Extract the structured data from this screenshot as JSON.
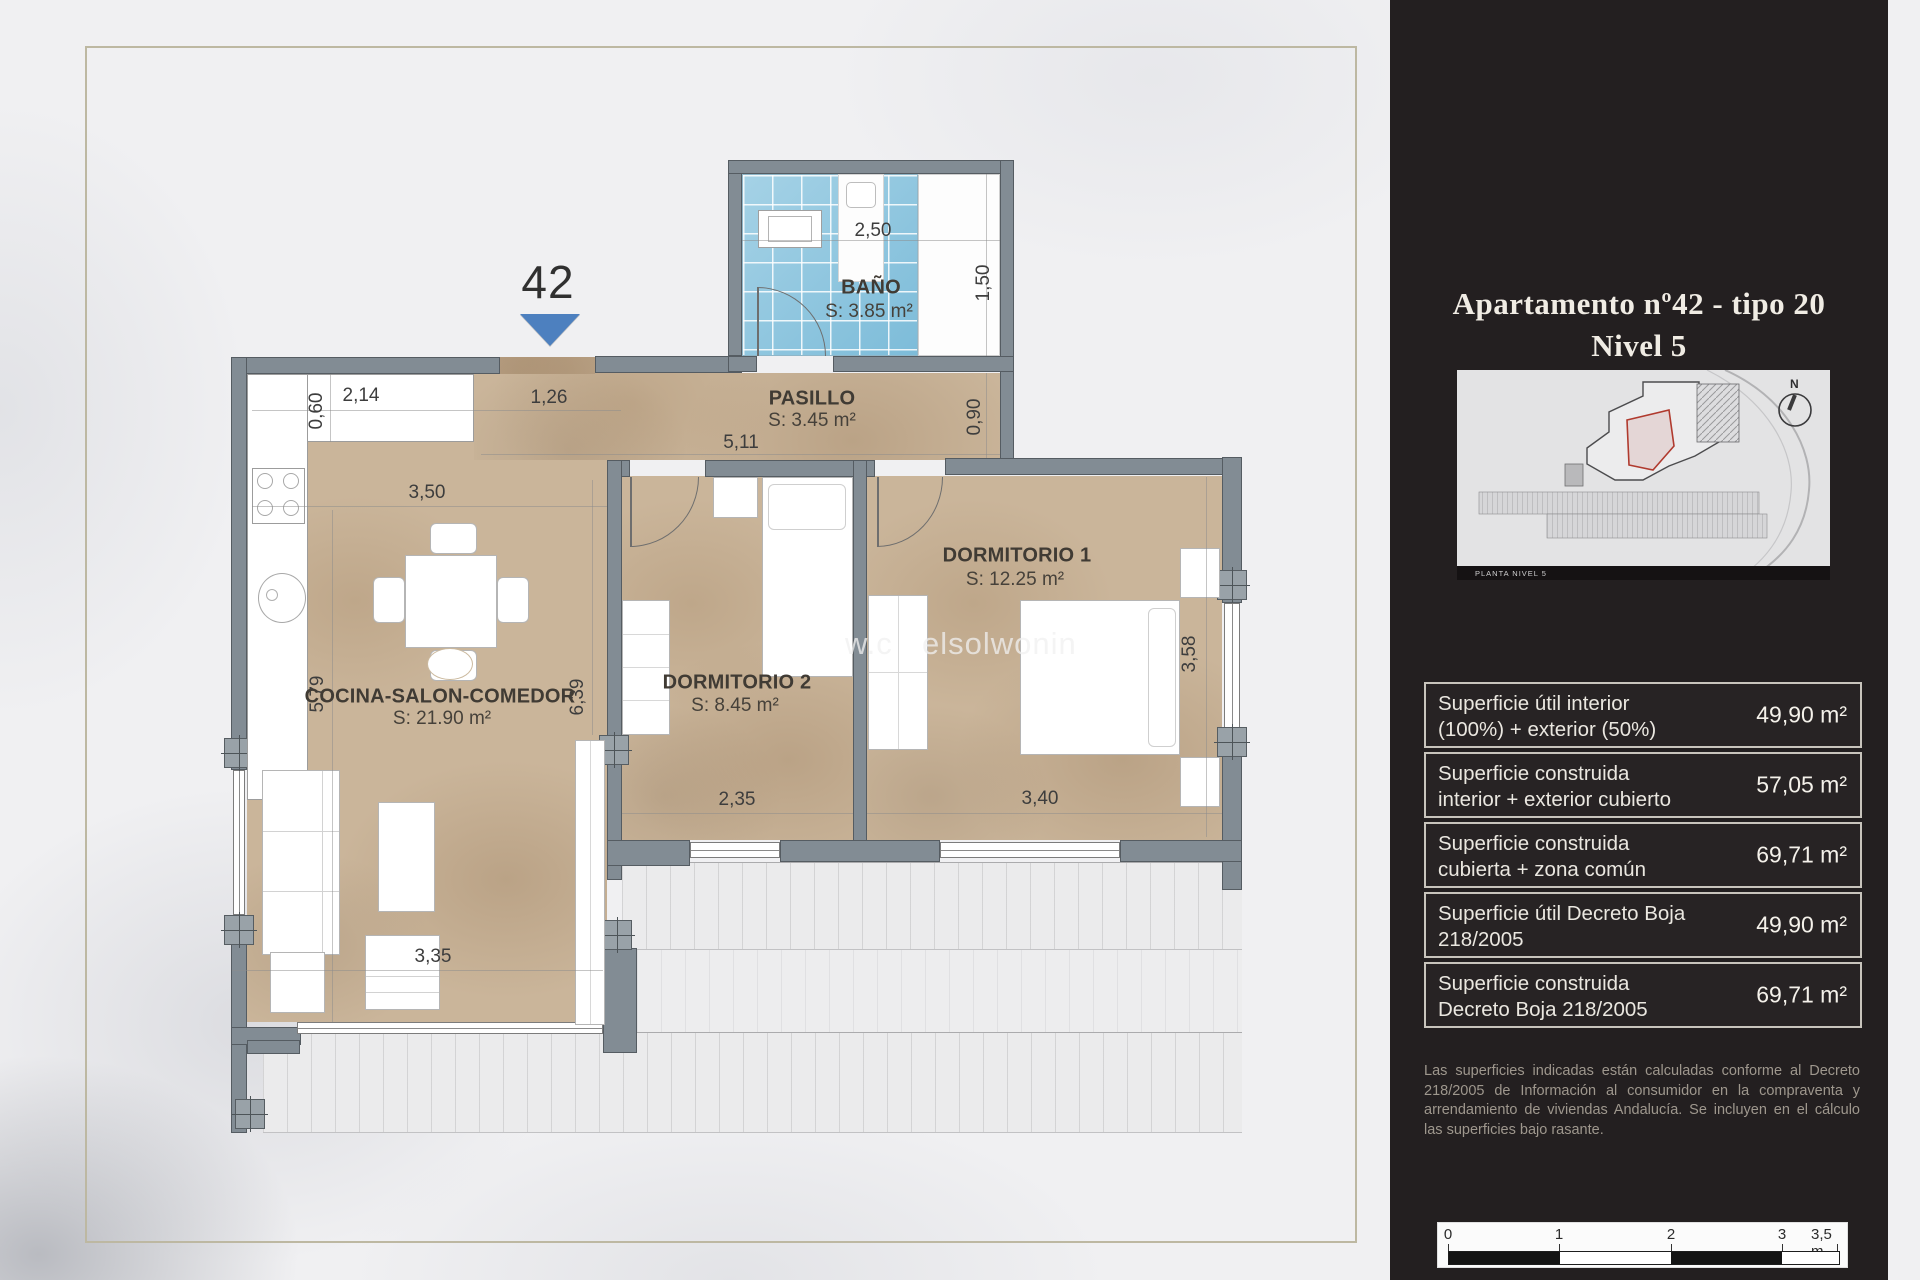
{
  "plan": {
    "unit_number": "42",
    "watermark_left": "w.c",
    "watermark_right": "elsolwonin",
    "rooms": [
      {
        "name": "BAÑO",
        "area": "S: 3.85 m²"
      },
      {
        "name": "PASILLO",
        "area": "S: 3.45 m²"
      },
      {
        "name": "DORMITORIO 1",
        "area": "S: 12.25 m²"
      },
      {
        "name": "DORMITORIO 2",
        "area": "S: 8.45 m²"
      },
      {
        "name": "COCINA-SALON-COMEDOR",
        "area": "S: 21.90 m²"
      }
    ],
    "dims": [
      {
        "text": "2,50"
      },
      {
        "text": "1,50"
      },
      {
        "text": "0,90"
      },
      {
        "text": "5,11"
      },
      {
        "text": "1,26"
      },
      {
        "text": "2,14"
      },
      {
        "text": "0,60"
      },
      {
        "text": "3,50"
      },
      {
        "text": "5,79"
      },
      {
        "text": "6,39"
      },
      {
        "text": "3,35"
      },
      {
        "text": "2,35"
      },
      {
        "text": "3,40"
      },
      {
        "text": "3,58"
      }
    ]
  },
  "panel": {
    "title_line1": "Apartamento nº42 - tipo 20",
    "title_line2": "Nivel 5",
    "compass_label": "N",
    "map_caption": "PLANTA NIVEL 5",
    "table": {
      "rows": [
        {
          "line1": "Superficie útil interior",
          "line2": "(100%) + exterior (50%)",
          "value": "49,90 m²"
        },
        {
          "line1": "Superficie construida",
          "line2": "interior + exterior cubierto",
          "value": "57,05 m²"
        },
        {
          "line1": "Superficie construida",
          "line2": "cubierta + zona común",
          "value": "69,71 m²"
        },
        {
          "line1": "Superficie útil Decreto Boja",
          "line2": "218/2005",
          "value": "49,90 m²"
        },
        {
          "line1": "Superficie construida",
          "line2": "Decreto Boja 218/2005",
          "value": "69,71 m²"
        }
      ]
    },
    "disclaimer": "Las superficies indicadas están calculadas conforme al Decreto 218/2005 de Información al consumidor en la compraventa y arrendamiento de viviendas Andalucía. Se incluyen en el cálculo las superficies bajo rasante.",
    "scalebar": {
      "t0": "0",
      "t1": "1",
      "t2": "2",
      "t3": "3",
      "t35": "3,5 m"
    }
  },
  "colors": {
    "accent_blue": "#4d80bf",
    "panel_bg": "#231f20",
    "tile_blue": "#7dbcd9",
    "floor_tan": "#cab59a"
  }
}
